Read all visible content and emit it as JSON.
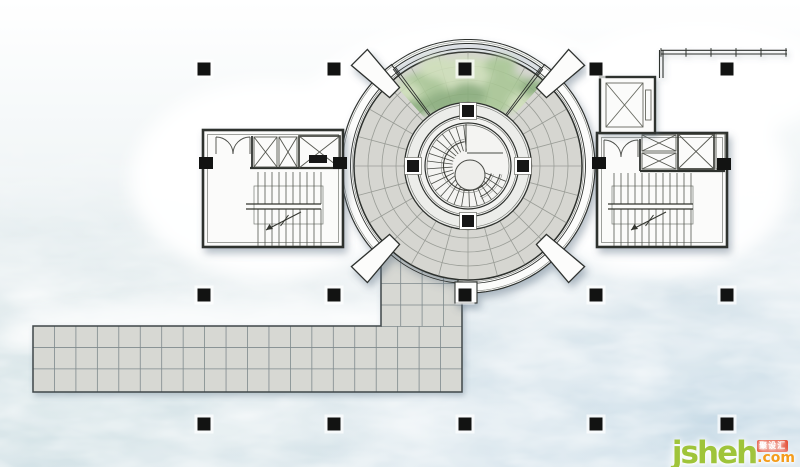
{
  "watermark": {
    "brand": "jsheh",
    "tld": ".com",
    "badge": "聚设汇"
  },
  "palette": {
    "water_base": "#eaf0f3",
    "water_deep": "#c7dbe8",
    "water_shallow": "#dfe9ea",
    "paving": "#d6d6d1",
    "paving_line": "#9a9d97",
    "grid_line": "#7f8a8d",
    "wall": "#2e302e",
    "thin_line": "#6d706b",
    "band_fill": "#fcfcfb",
    "ring_fill": "#ecedea",
    "well_fill": "#f4f4f2",
    "green_light": "#cfe0ba",
    "green_mid": "#a9c795",
    "green_dark": "#89ad7b",
    "column": "#121312",
    "room_fill": "#fbfbfa",
    "shadow": "#5c7080",
    "logo_green": "#9fc43a",
    "logo_orange": "#f49c1b",
    "logo_red": "#e4472e"
  },
  "plan": {
    "center": [
      468,
      166
    ],
    "floor_radius": 114,
    "floor_outer": 117.5,
    "floor_arcs": [
      72,
      86,
      100
    ],
    "spokes": {
      "step": 15,
      "r1": 63,
      "r2": 113.5
    },
    "band": {
      "r1": 114,
      "r2": 127,
      "segments": [
        [
          127,
          225
        ],
        [
          -95,
          53
        ]
      ]
    },
    "glass_arc": {
      "r1": 122.5,
      "r2": 126.5,
      "a1": 53,
      "a2": 127
    },
    "sector_angles": [
      53,
      127
    ],
    "fins": {
      "angles": [
        45,
        135,
        225,
        315
      ],
      "r1": 104,
      "r2": 154,
      "d1": 3.9,
      "d2": 4.2
    },
    "ring": {
      "outer": 63.5,
      "outer2": 61.2,
      "inner": 50.5,
      "inner2": 48.6,
      "well": 43,
      "well2": 41
    },
    "ring_columns": {
      "angles": [
        0,
        90,
        180,
        270
      ],
      "r": 55,
      "size": 12
    },
    "treads": {
      "a1": 96,
      "a2": 344,
      "step": 11,
      "r1": 15.5,
      "r2": 41
    },
    "handrail": {
      "r": 24.5,
      "r2": 26.8,
      "a1": 98,
      "a2": 342
    },
    "landing": {
      "v": [
        466,
        124,
        466,
        152
      ],
      "h": [
        467,
        153,
        503,
        153
      ],
      "arc_r": 33,
      "arc_a1": -68,
      "arc_a2": -14
    },
    "spiral_eye": {
      "cx": 470,
      "cy": 175,
      "r": 15
    },
    "column_grid": {
      "xs": [
        204,
        334,
        465,
        596,
        727
      ],
      "rows": [
        69,
        295,
        424
      ],
      "size": 13
    },
    "wall_columns": [
      [
        206,
        163
      ],
      [
        340,
        163
      ],
      [
        599,
        163
      ],
      [
        724,
        164
      ]
    ],
    "walkway": {
      "x": 33,
      "y": 326,
      "w": 429,
      "h": 66,
      "cell": 21.45
    },
    "path": {
      "x": 381,
      "top": 250,
      "right": 462,
      "vxs": [
        400.7,
        422.1,
        443.6
      ],
      "hys": [
        283.5,
        305
      ]
    },
    "railing": {
      "x1": 661,
      "x2": 787,
      "y1": 50.3,
      "y2": 54,
      "tick_step": 25
    },
    "green_blobs": [
      [
        425,
        88,
        26,
        16,
        "m"
      ],
      [
        468,
        74,
        30,
        17,
        "l"
      ],
      [
        507,
        88,
        24,
        15,
        "m"
      ],
      [
        445,
        104,
        20,
        13,
        "d"
      ],
      [
        492,
        102,
        22,
        13,
        "m"
      ],
      [
        414,
        108,
        14,
        10,
        "d"
      ],
      [
        524,
        103,
        16,
        11,
        "l"
      ],
      [
        468,
        95,
        18,
        12,
        "d"
      ],
      [
        438,
        68,
        18,
        11,
        "l"
      ],
      [
        500,
        66,
        16,
        10,
        "m"
      ],
      [
        532,
        88,
        12,
        9,
        "d"
      ],
      [
        408,
        92,
        13,
        9,
        "l"
      ]
    ],
    "stairs": [
      {
        "x1": 258,
        "x2": 321,
        "step": 7,
        "top": 172,
        "mid1": 204,
        "mid2": 209,
        "bot": 246,
        "railx1": 246,
        "arrow": [
          [
            301,
            212
          ],
          [
            266,
            230
          ]
        ]
      },
      {
        "x1": 614,
        "x2": 693,
        "step": 7,
        "top": 173,
        "mid1": 204,
        "mid2": 209,
        "bot": 246,
        "railx1": 608,
        "arrow": [
          [
            666,
            212
          ],
          [
            631,
            230
          ]
        ]
      }
    ]
  }
}
